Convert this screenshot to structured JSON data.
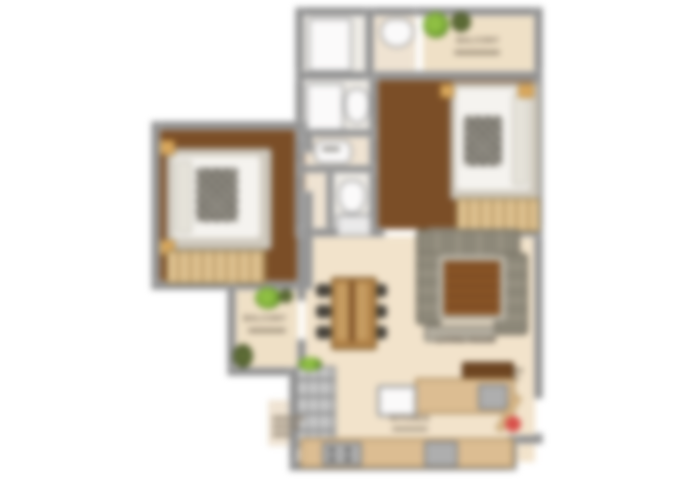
{
  "image": {
    "type": "blurred-apartment-floor-plan",
    "background": "#ffffff",
    "description": "Top-down 2D rendered floor plan of a two-bedroom apartment, heavily blurred"
  },
  "palette": {
    "wall_gray": "#8e8e8e",
    "bedroom_wood_floor": "#7b4e27",
    "living_cream_floor": "#f2e3cb",
    "balcony_floor": "#efe0c6",
    "counter_tan": "#dcbd92",
    "wardrobe_tan": "#dfc291",
    "sofa_gray_olive": "#8d8879",
    "rug_brown": "#8a5527",
    "dining_table_wood": "#b08147",
    "chair_dark": "#46423a",
    "plant_green": "#8fbf43",
    "bed_linen_white": "#f5f3ef",
    "entry_marker_red": "#d8504a"
  },
  "labels": {
    "balcony_top": "BALCONY",
    "balcony_left": "BALCONY",
    "kitchen": "KITCHEN",
    "living": "LIVING ROOM"
  },
  "rooms": [
    {
      "name": "shower-room-top"
    },
    {
      "name": "toilet-top"
    },
    {
      "name": "balcony-top-right"
    },
    {
      "name": "master-bedroom-right"
    },
    {
      "name": "bathroom-middle"
    },
    {
      "name": "vanity-passage"
    },
    {
      "name": "bathroom-lower"
    },
    {
      "name": "bedroom-left"
    },
    {
      "name": "balcony-left"
    },
    {
      "name": "living-dining"
    },
    {
      "name": "kitchen"
    }
  ],
  "furniture": [
    {
      "name": "double-bed-right"
    },
    {
      "name": "double-bed-left"
    },
    {
      "name": "wardrobe-right"
    },
    {
      "name": "wardrobe-left"
    },
    {
      "name": "dining-table-six-chairs"
    },
    {
      "name": "sofa-set-u-shape"
    },
    {
      "name": "coffee-rug"
    },
    {
      "name": "tv-console"
    },
    {
      "name": "kitchen-counters"
    },
    {
      "name": "kitchen-island"
    },
    {
      "name": "shelf-unit"
    },
    {
      "name": "potted-plants"
    }
  ],
  "markers": {
    "entry_dot_color": "#d8504a"
  }
}
